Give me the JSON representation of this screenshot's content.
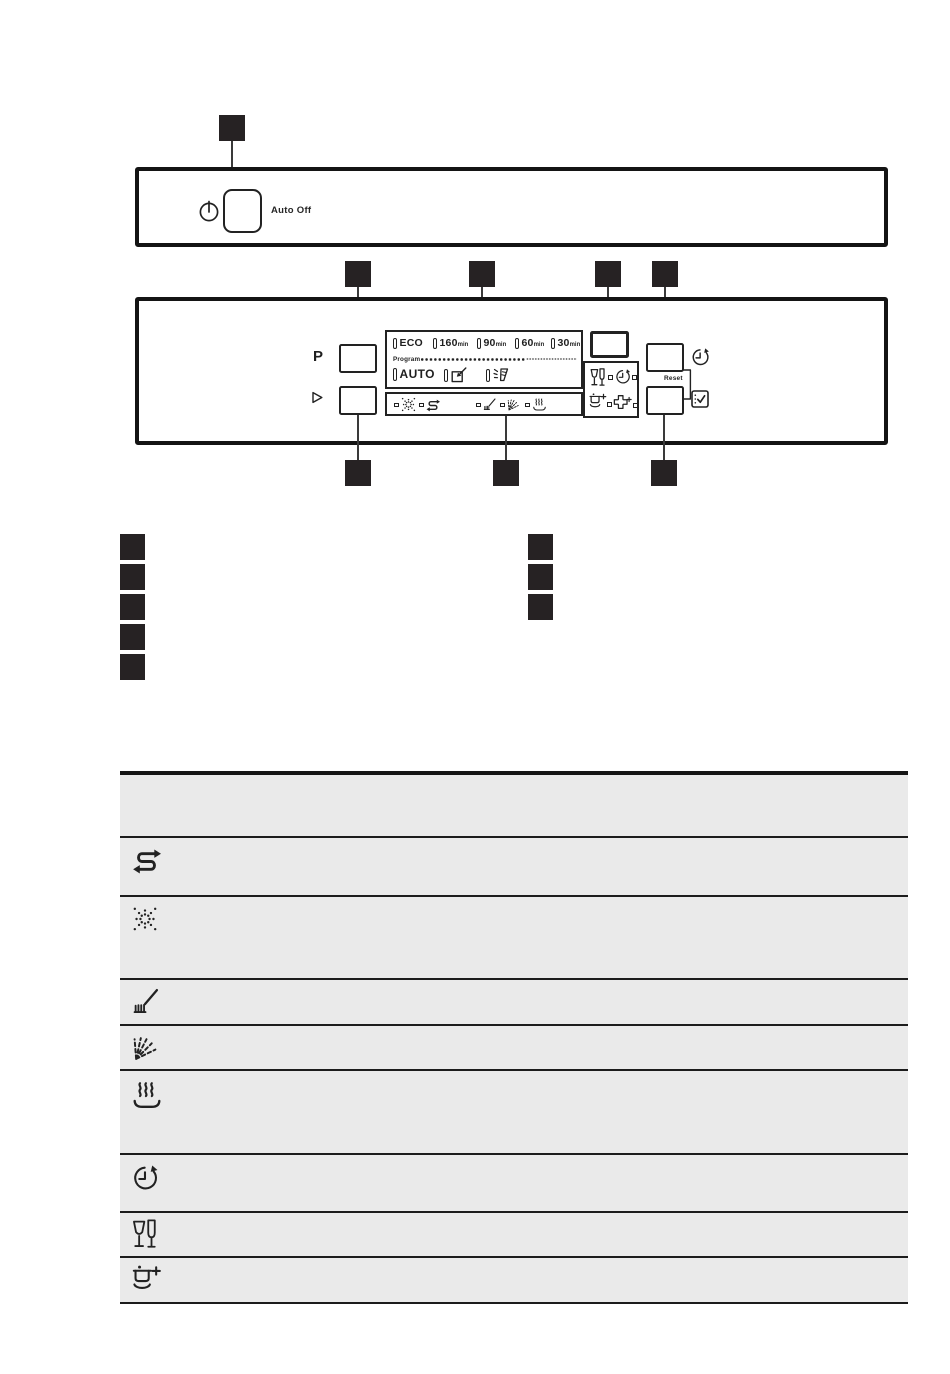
{
  "colors": {
    "ink": "#222222",
    "panel_border": "#141414",
    "callout_fill": "#262223",
    "table_background": "#eaeaea",
    "page_background": "#ffffff"
  },
  "panel1": {
    "power_icon": "power-icon",
    "auto_off_label": "Auto Off"
  },
  "panel2": {
    "program_key_label": "P",
    "start_key_icon": "play-icon",
    "display": {
      "row1": [
        {
          "label": "ECO",
          "unit": ""
        },
        {
          "label": "160",
          "unit": "min"
        },
        {
          "label": "90",
          "unit": "min"
        },
        {
          "label": "60",
          "unit": "min"
        },
        {
          "label": "30",
          "unit": "min"
        }
      ],
      "program_caption": "Program",
      "row2_label": "AUTO",
      "row2_icons": [
        "machine-care-icon",
        "rinse-program-icon"
      ]
    },
    "status_strip_icons": [
      "rinse-aid-icon",
      "salt-icon",
      "washing-phase-icon",
      "rinsing-phase-icon",
      "drying-phase-icon"
    ],
    "option_box_icons": [
      "glass-icon",
      "time-icon",
      "extra-power-icon",
      "option-cross-icon"
    ],
    "delay_side_icon": "delay-icon",
    "reset_label": "Reset",
    "ok_side_icon": "ok-icon"
  },
  "legend_table": {
    "row_icons": [
      "",
      "salt-icon",
      "rinse-aid-icon",
      "washing-phase-icon",
      "rinsing-phase-icon",
      "drying-phase-icon",
      "delay-icon",
      "glass-icon",
      "extra-power-icon"
    ]
  }
}
